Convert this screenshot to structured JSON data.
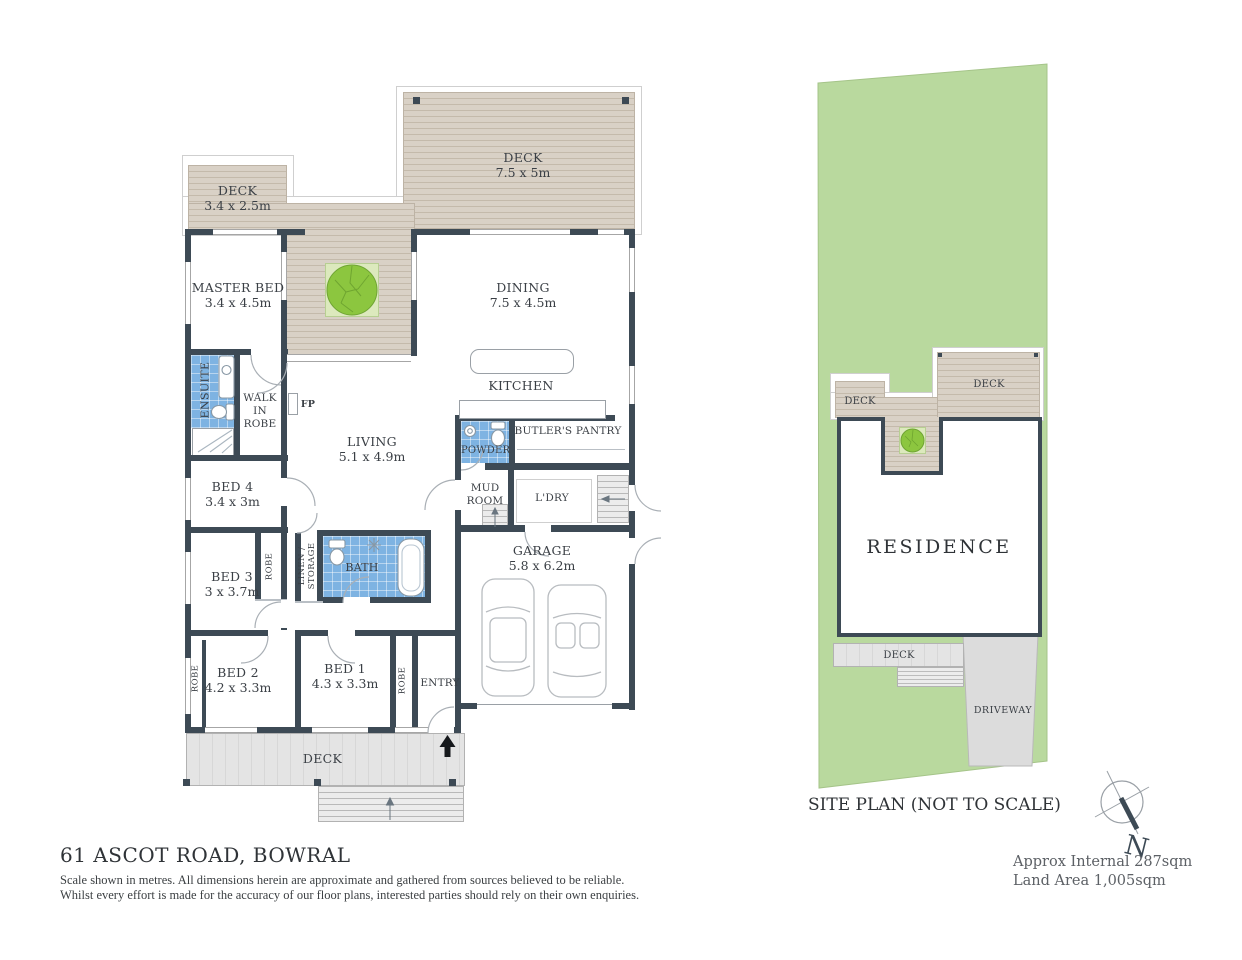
{
  "page": {
    "address": "61 ASCOT ROAD, BOWRAL",
    "disclaimer1": "Scale shown in metres. All dimensions herein are approximate and gathered from sources believed to be  reliable.",
    "disclaimer2": "Whilst every effort is made for the accuracy of our floor plans, interested parties should rely on their own enquiries."
  },
  "floor_plan": {
    "rooms": {
      "deck_top_left": {
        "label": "DECK",
        "dims": "3.4 x 2.5m"
      },
      "deck_top_right": {
        "label": "DECK",
        "dims": "7.5 x 5m"
      },
      "master_bed": {
        "label": "MASTER BED",
        "dims": "3.4 x 4.5m"
      },
      "dining": {
        "label": "DINING",
        "dims": "7.5 x 4.5m"
      },
      "kitchen": {
        "label": "KITCHEN"
      },
      "living": {
        "label": "LIVING",
        "dims": "5.1 x 4.9m"
      },
      "ensuite": {
        "label": "ENSUITE"
      },
      "walk_in_robe": {
        "label": "WALK IN ROBE"
      },
      "fireplace": {
        "label": "FP"
      },
      "powder": {
        "label": "POWDER"
      },
      "butlers_pantry": {
        "label": "BUTLER'S PANTRY"
      },
      "bed4": {
        "label": "BED 4",
        "dims": "3.4 x 3m"
      },
      "mud_room": {
        "label": "MUD ROOM"
      },
      "laundry": {
        "label": "L'DRY"
      },
      "bed3": {
        "label": "BED 3",
        "dims": "3 x 3.7m"
      },
      "robe_bed3": {
        "label": "ROBE"
      },
      "linen_storage": {
        "label": "LINEN / STORAGE"
      },
      "bath": {
        "label": "BATH"
      },
      "garage": {
        "label": "GARAGE",
        "dims": "5.8 x 6.2m"
      },
      "bed2": {
        "label": "BED 2",
        "dims": "4.2 x 3.3m"
      },
      "bed1": {
        "label": "BED 1",
        "dims": "4.3 x 3.3m"
      },
      "robe_bed2": {
        "label": "ROBE"
      },
      "robe_bed1": {
        "label": "ROBE"
      },
      "entry": {
        "label": "ENTRY"
      },
      "deck_bottom": {
        "label": "DECK"
      }
    }
  },
  "site_plan": {
    "caption": "SITE PLAN (NOT TO SCALE)",
    "residence_label": "RESIDENCE",
    "deck_left_label": "DECK",
    "deck_right_label": "DECK",
    "deck_bottom_label": "DECK",
    "driveway_label": "DRIVEWAY",
    "compass": {
      "north_label": "N"
    },
    "approx_internal": "Approx Internal 287sqm",
    "land_area": "Land Area 1,005sqm"
  },
  "colors": {
    "wall": "#3d4a55",
    "deck_hatch": "#d9d1c6",
    "wet_area_blue": "#7eb3e2",
    "land_green": "#b9d99e",
    "tree_green": "#8cc63f",
    "driveway_gray": "#dcdcdc"
  }
}
